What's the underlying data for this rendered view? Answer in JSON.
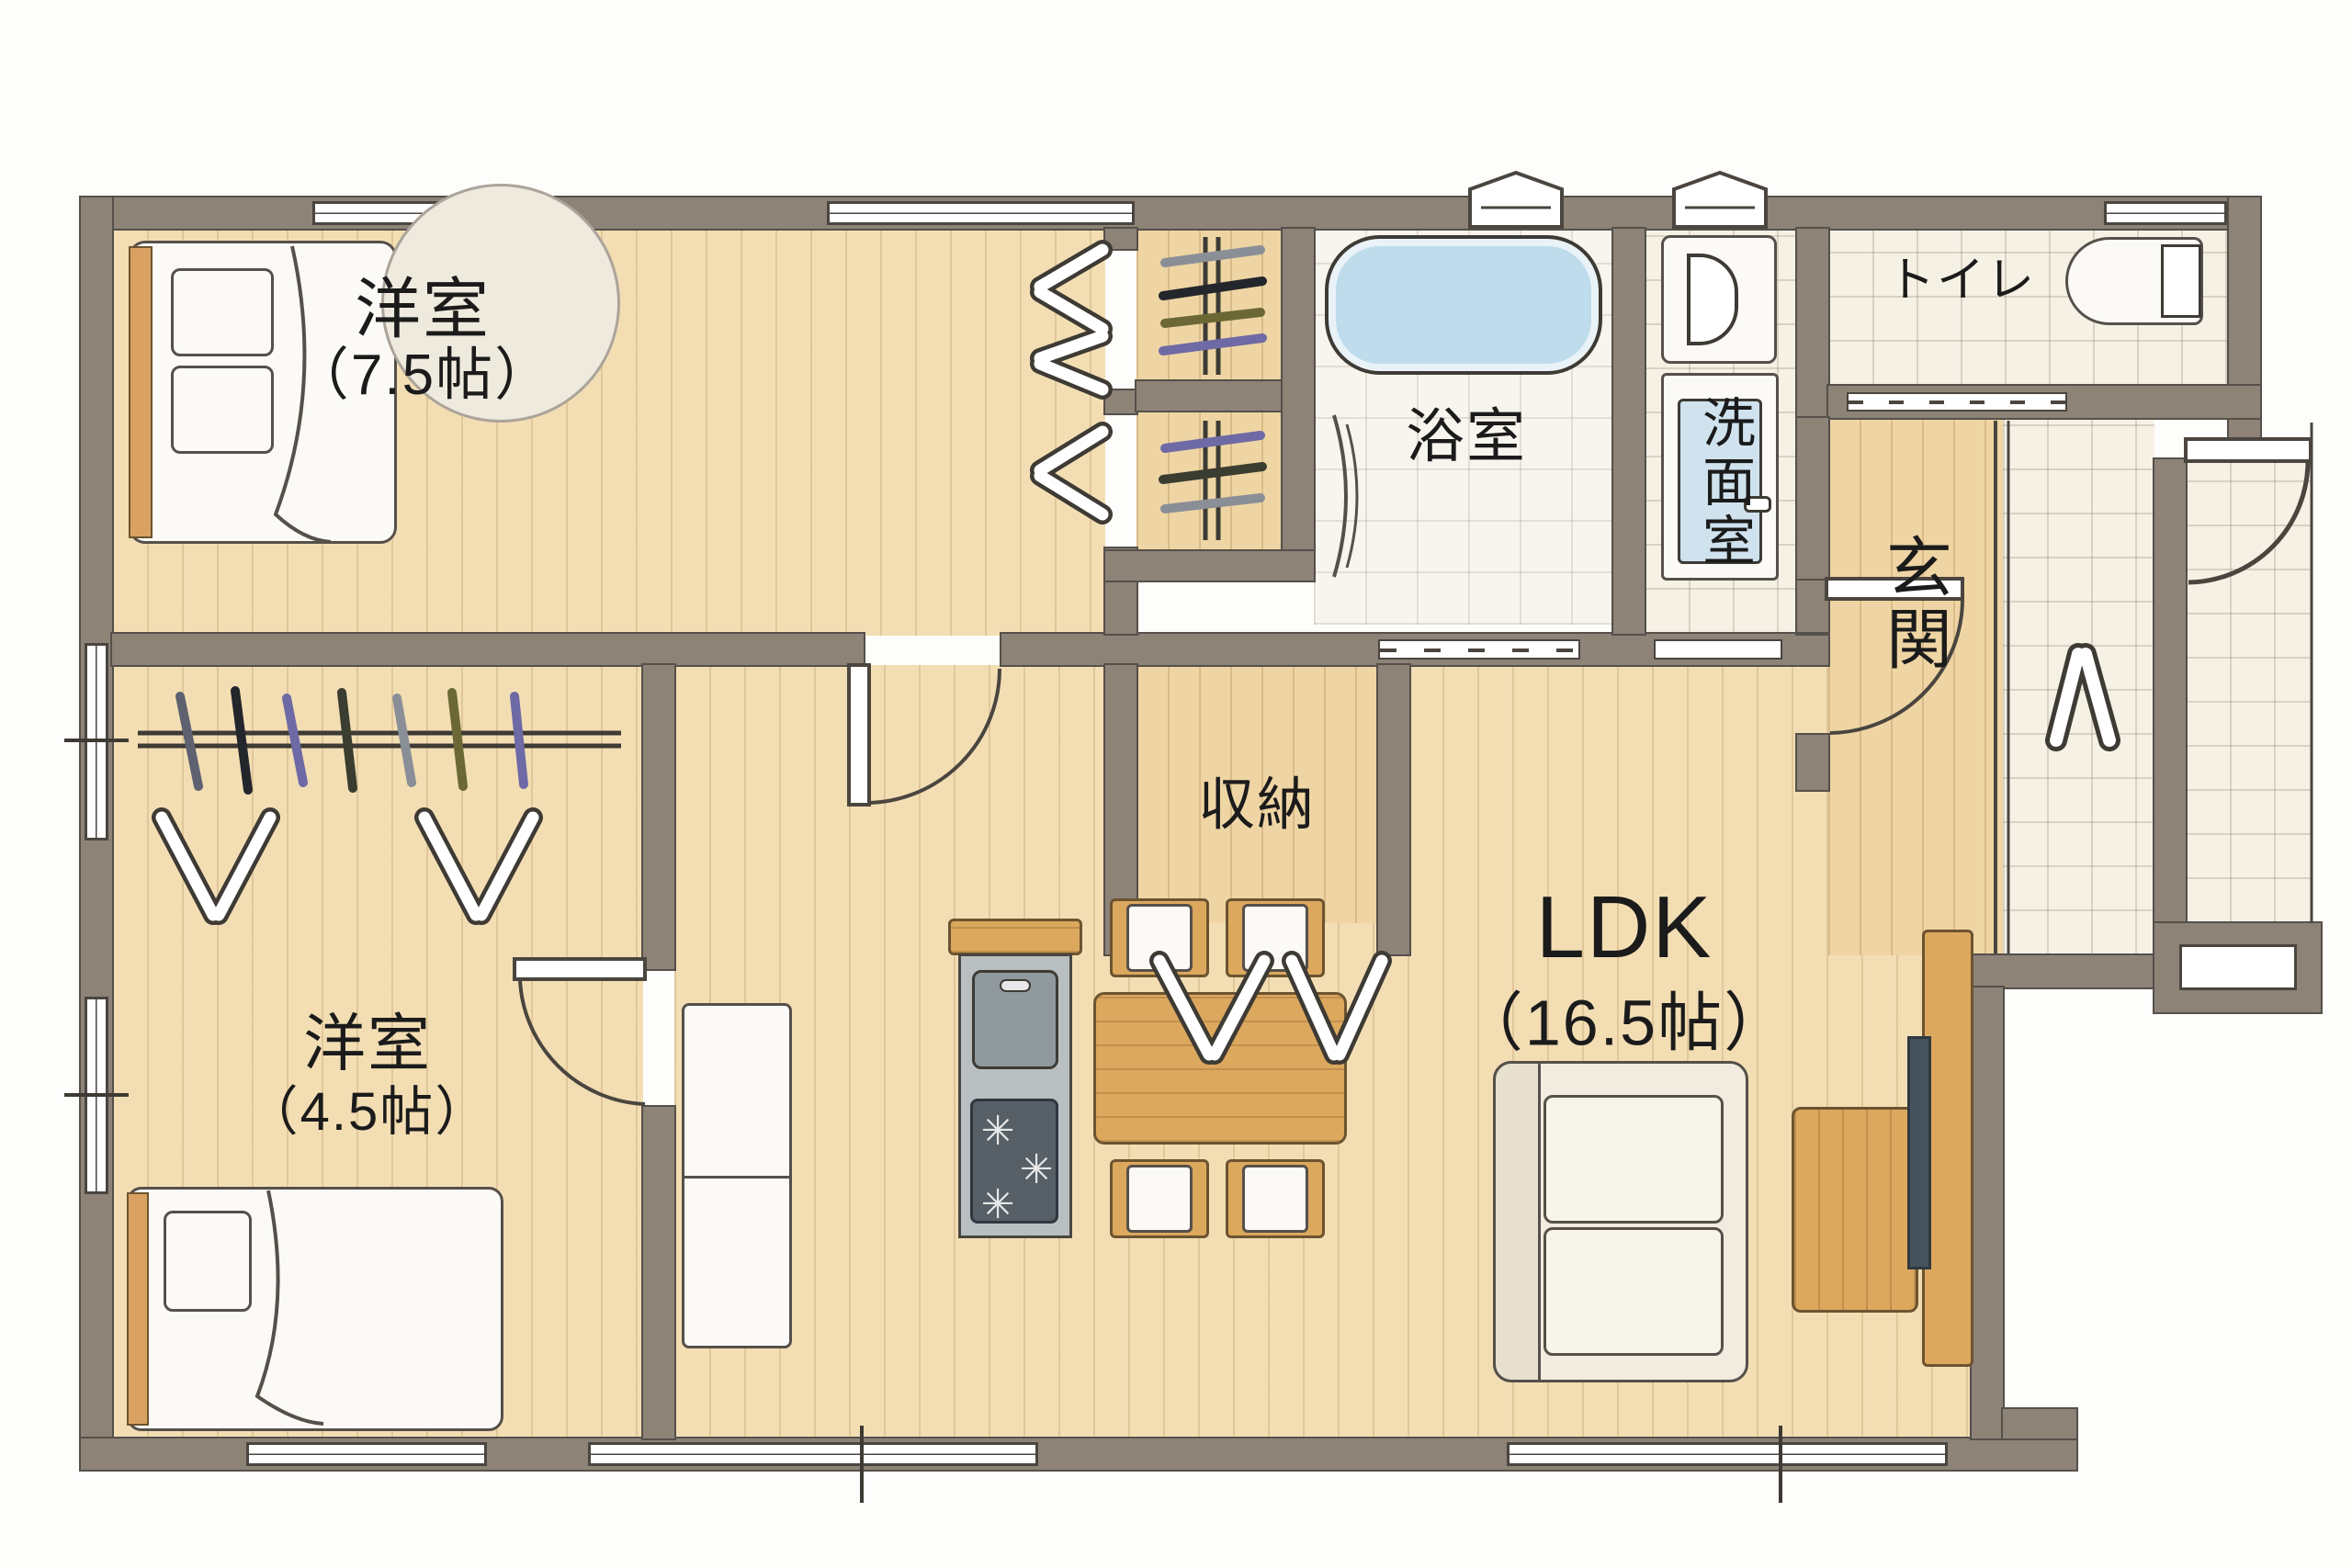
{
  "plan_title": "1LDK+2洋室 間取り図",
  "rooms": {
    "western75": {
      "name": "洋室",
      "size": "（7.5帖）"
    },
    "western45": {
      "name": "洋室",
      "size": "（4.5帖）"
    },
    "ldk": {
      "name": "LDK",
      "size": "（16.5帖）"
    },
    "bath": {
      "name": "浴室"
    },
    "washroom": {
      "name": "洗面室"
    },
    "toilet": {
      "name": "トイレ"
    },
    "entrance": {
      "name": "玄関"
    },
    "storage": {
      "name": "収納"
    }
  },
  "fixtures": {
    "double_bed": "ダブルベッド",
    "single_bed": "シングルベッド",
    "round_rug": "ラグ",
    "closet_hangers": "クローゼット",
    "bathtub": "浴槽",
    "washing_machine": "洗濯機",
    "vanity": "洗面台",
    "toilet_bowl": "便器",
    "kitchen_island": "キッチン",
    "refrigerator": "冷蔵庫",
    "dining_table": "ダイニングテーブル",
    "dining_chair": "チェア",
    "sofa": "ソファ",
    "coffee_table": "ローテーブル",
    "tv_board": "テレビボード",
    "entrance_step": "ポーチ"
  },
  "colors": {
    "wall": "#8d8377",
    "wood_floor": "#f3deb4",
    "tile_floor": "#f6f1e5",
    "tub_water": "#bedceb",
    "furniture_wood": "#dca85e",
    "appliance_dark": "#566066",
    "tv_dark": "#46525c"
  }
}
